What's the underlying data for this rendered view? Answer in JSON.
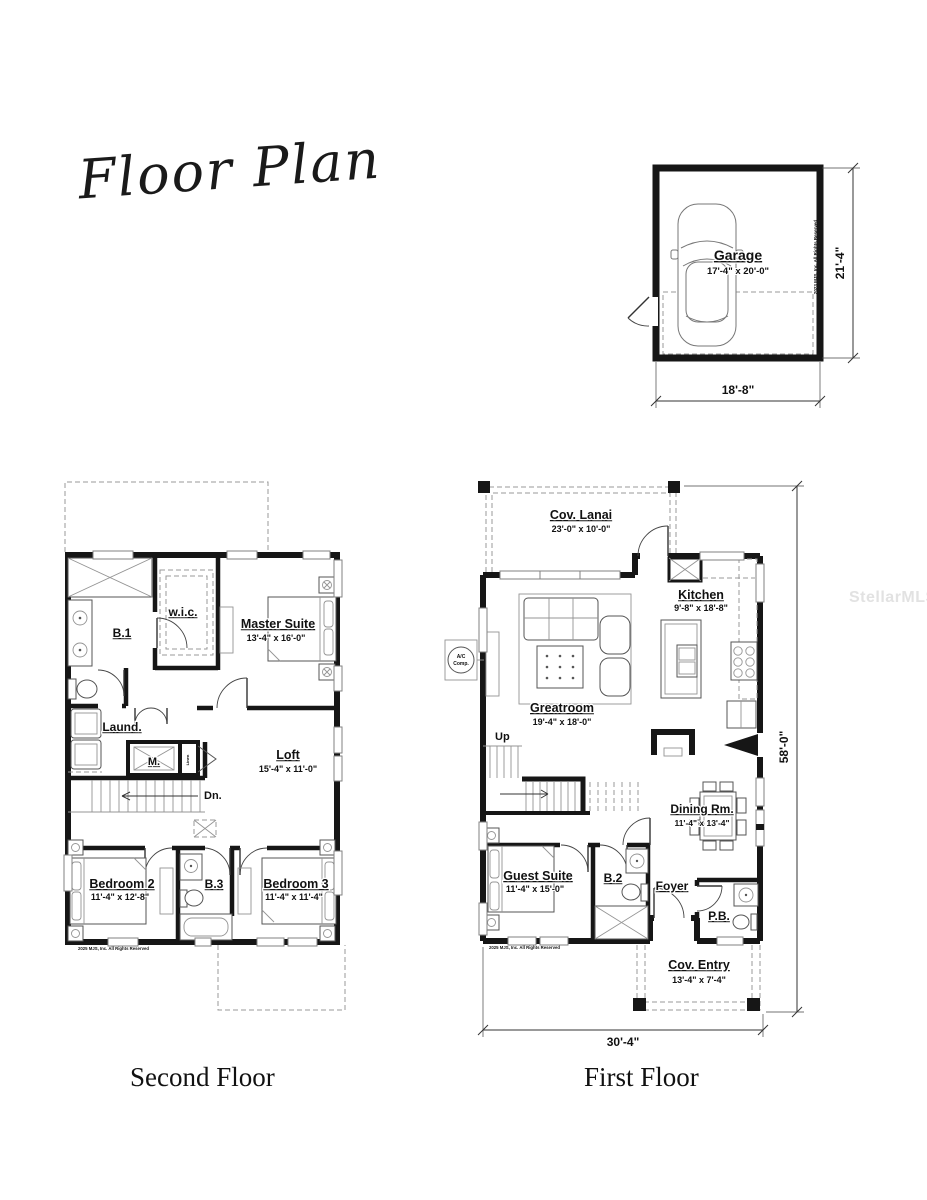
{
  "title": "Floor Plan",
  "watermark": "StellarMLS",
  "colors": {
    "wall": "#161616",
    "fixture_line": "#555555",
    "dashed_line": "#999999",
    "watermark_gray": "#e2e2e2",
    "background": "#ffffff"
  },
  "garage": {
    "name": "Garage",
    "dims": "17'-4\" x 20'-0\"",
    "width_dim": "18'-8\"",
    "height_dim": "21'-4\"",
    "copyright": "2023 MJS, Inc. All Rights Reserved"
  },
  "second_floor": {
    "label": "Second Floor",
    "copyright": "2025 MJS, Inc. All Rights Reserved",
    "rooms": {
      "b1": {
        "name": "B.1"
      },
      "wic": {
        "name": "w.i.c."
      },
      "master": {
        "name": "Master Suite",
        "dims": "13'-4\" x 16'-0\""
      },
      "laundry": {
        "name": "Laund."
      },
      "mech": {
        "name": "M."
      },
      "linen": {
        "name": "Linen"
      },
      "loft": {
        "name": "Loft",
        "dims": "15'-4\" x 11'-0\""
      },
      "down": {
        "name": "Dn."
      },
      "bedroom2": {
        "name": "Bedroom 2",
        "dims": "11'-4\" x 12'-8\""
      },
      "b3": {
        "name": "B.3"
      },
      "bedroom3": {
        "name": "Bedroom 3",
        "dims": "11'-4\" x 11'-4\""
      }
    }
  },
  "first_floor": {
    "label": "First Floor",
    "copyright": "2025 MJS, Inc. All Rights Reserved",
    "width_dim": "30'-4\"",
    "height_dim": "58'-0\"",
    "ac": {
      "line1": "A/C",
      "line2": "Comp."
    },
    "rooms": {
      "lanai": {
        "name": "Cov. Lanai",
        "dims": "23'-0\" x 10'-0\""
      },
      "kitchen": {
        "name": "Kitchen",
        "dims": "9'-8\" x 18'-8\""
      },
      "greatroom": {
        "name": "Greatroom",
        "dims": "19'-4\" x 18'-0\""
      },
      "up": {
        "name": "Up"
      },
      "dining": {
        "name": "Dining Rm.",
        "dims": "11'-4\" x 13'-4\""
      },
      "guest": {
        "name": "Guest Suite",
        "dims": "11'-4\" x 15'-0\""
      },
      "b2": {
        "name": "B.2"
      },
      "foyer": {
        "name": "Foyer"
      },
      "pb": {
        "name": "P.B."
      },
      "entry": {
        "name": "Cov. Entry",
        "dims": "13'-4\" x 7'-4\""
      }
    }
  }
}
